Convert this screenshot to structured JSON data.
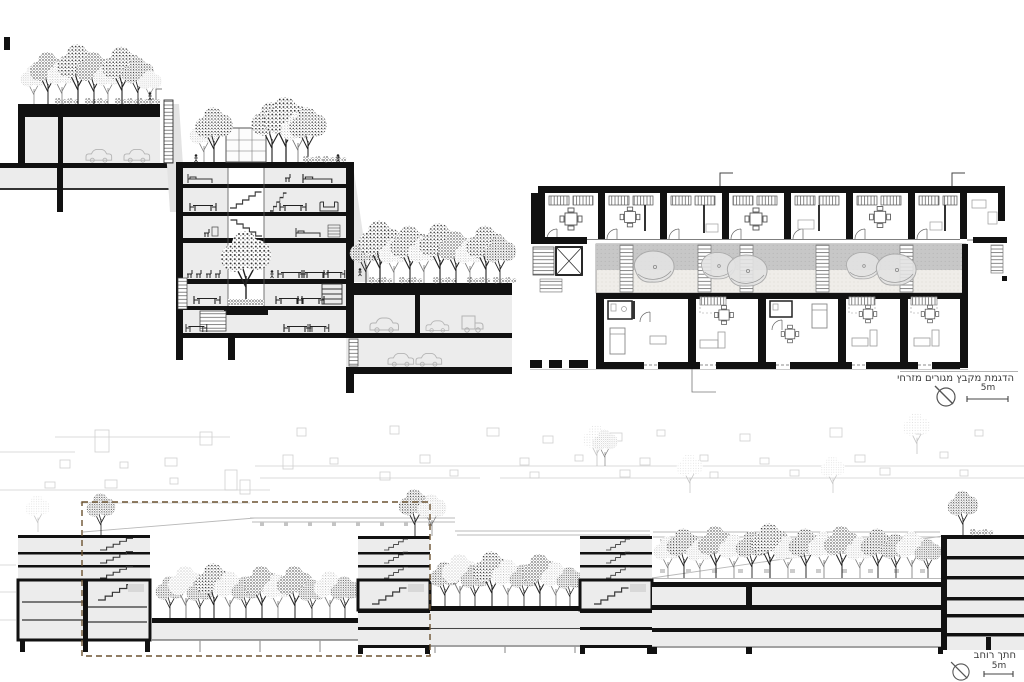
{
  "colors": {
    "ink": "#111111",
    "fill-light": "#ececec",
    "fill-mid": "#c9c9c9",
    "line-faint": "#cfcfcf",
    "dash-highlight": "#6b5230",
    "label": "#3a3a3a"
  },
  "plan_panel": {
    "caption": "הדגמת מקבץ מגורים מזרחי",
    "scale_label": "5m"
  },
  "street_section_panel": {
    "caption": "חתך רוחב",
    "scale_label": "5m"
  }
}
